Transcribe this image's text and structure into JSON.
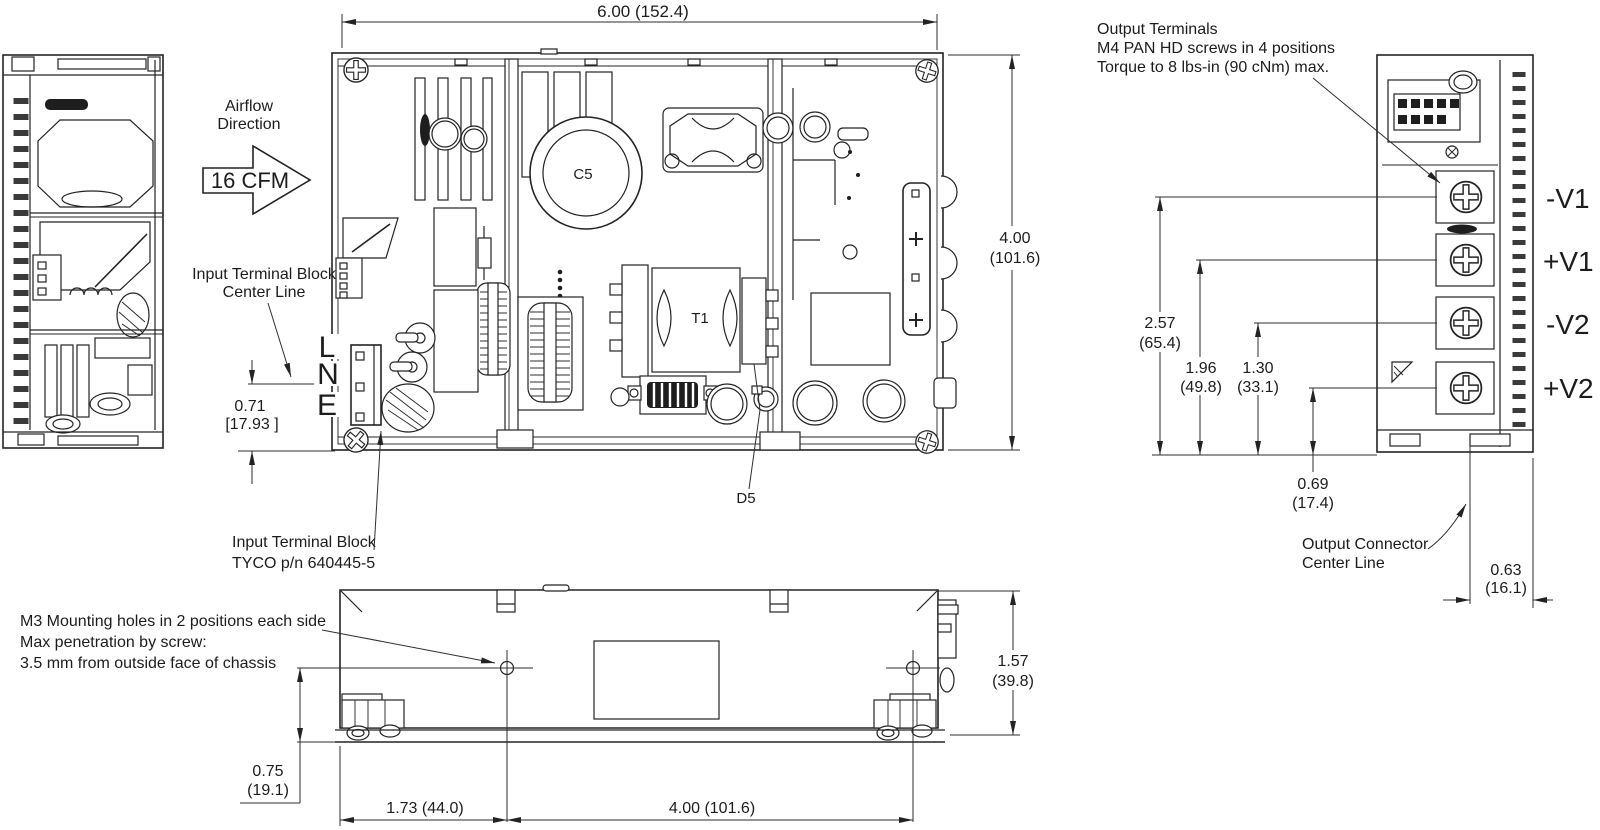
{
  "drawing": {
    "airflow": {
      "line1": "Airflow",
      "line2": "Direction",
      "cfm": "16 CFM"
    },
    "input_terminal_center": {
      "line1": "Input Terminal Block",
      "line2": "Center Line"
    },
    "input_terminal_note": {
      "line1": "Input Terminal Block",
      "line2": "TYCO p/n 640445-5"
    },
    "input_labels": {
      "l": "L",
      "n": "N",
      "e": "E"
    },
    "components": {
      "c5": "C5",
      "t1": "T1",
      "d5": "D5"
    },
    "output_terminals_note": {
      "line1": "Output Terminals",
      "line2": "M4 PAN HD screws in 4 positions",
      "line3": "Torque to 8 lbs-in (90 cNm) max."
    },
    "terminals": [
      "-V1",
      "+V1",
      "-V2",
      "+V2"
    ],
    "output_connector_note": {
      "line1": "Output Connector",
      "line2": "Center Line"
    },
    "m3_note": {
      "line1": "M3 Mounting holes in 2 positions each side",
      "line2": "Max penetration by screw:",
      "line3": "3.5 mm from outside face of chassis"
    },
    "dims": {
      "overall_width": "6.00 (152.4)",
      "overall_depth_in": "4.00",
      "overall_depth_mm": "(101.6)",
      "input_tb_offset_in": "0.71",
      "input_tb_offset_mm": "[17.93 ]",
      "term1_in": "2.57",
      "term1_mm": "(65.4)",
      "term2_in": "1.96",
      "term2_mm": "(49.8)",
      "term3_in": "1.30",
      "term3_mm": "(33.1)",
      "term4_in": "0.69",
      "term4_mm": "(17.4)",
      "out_conn_in": "0.63",
      "out_conn_mm": "(16.1)",
      "height_in": "1.57",
      "height_mm": "(39.8)",
      "hole_offset_in": "0.75",
      "hole_offset_mm": "(19.1)",
      "hole_x1": "1.73 (44.0)",
      "hole_span": "4.00 (101.6)"
    }
  }
}
